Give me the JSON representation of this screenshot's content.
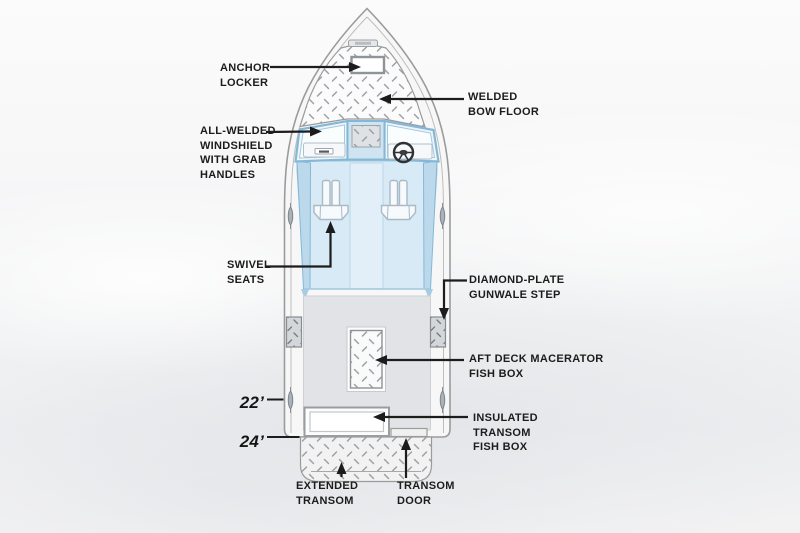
{
  "diagram_title": "Boat feature callout diagram (top view)",
  "callouts": {
    "anchor_locker": {
      "label": "ANCHOR\nLOCKER"
    },
    "welded_bow_floor": {
      "label": "WELDED\nBOW FLOOR"
    },
    "windshield": {
      "label": "ALL-WELDED\nWINDSHIELD\nWITH GRAB\nHANDLES"
    },
    "swivel_seats": {
      "label": "SWIVEL\nSEATS"
    },
    "gunwale_step": {
      "label": "DIAMOND-PLATE\nGUNWALE STEP"
    },
    "macerator_fish_box": {
      "label": "AFT DECK MACERATOR\nFISH BOX"
    },
    "insulated_fish_box": {
      "label": "INSULATED\nTRANSOM\nFISH BOX"
    },
    "extended_transom": {
      "label": "EXTENDED\nTRANSOM"
    },
    "transom_door": {
      "label": "TRANSOM\nDOOR"
    }
  },
  "dimensions": {
    "length_hull": "22’",
    "length_overall": "24’"
  },
  "colors": {
    "label_text": "#1c1c1c",
    "arrow": "#1c1c1c",
    "hull_stroke": "#9b9b9b",
    "hull_fill": "#f7f7f8",
    "windshield_frame_blue": "#85b8d6",
    "cockpit_blue": "#d8eaf5",
    "aft_deck_gray": "#e2e3e6",
    "plate_dash_gray": "#9aa1a7"
  }
}
